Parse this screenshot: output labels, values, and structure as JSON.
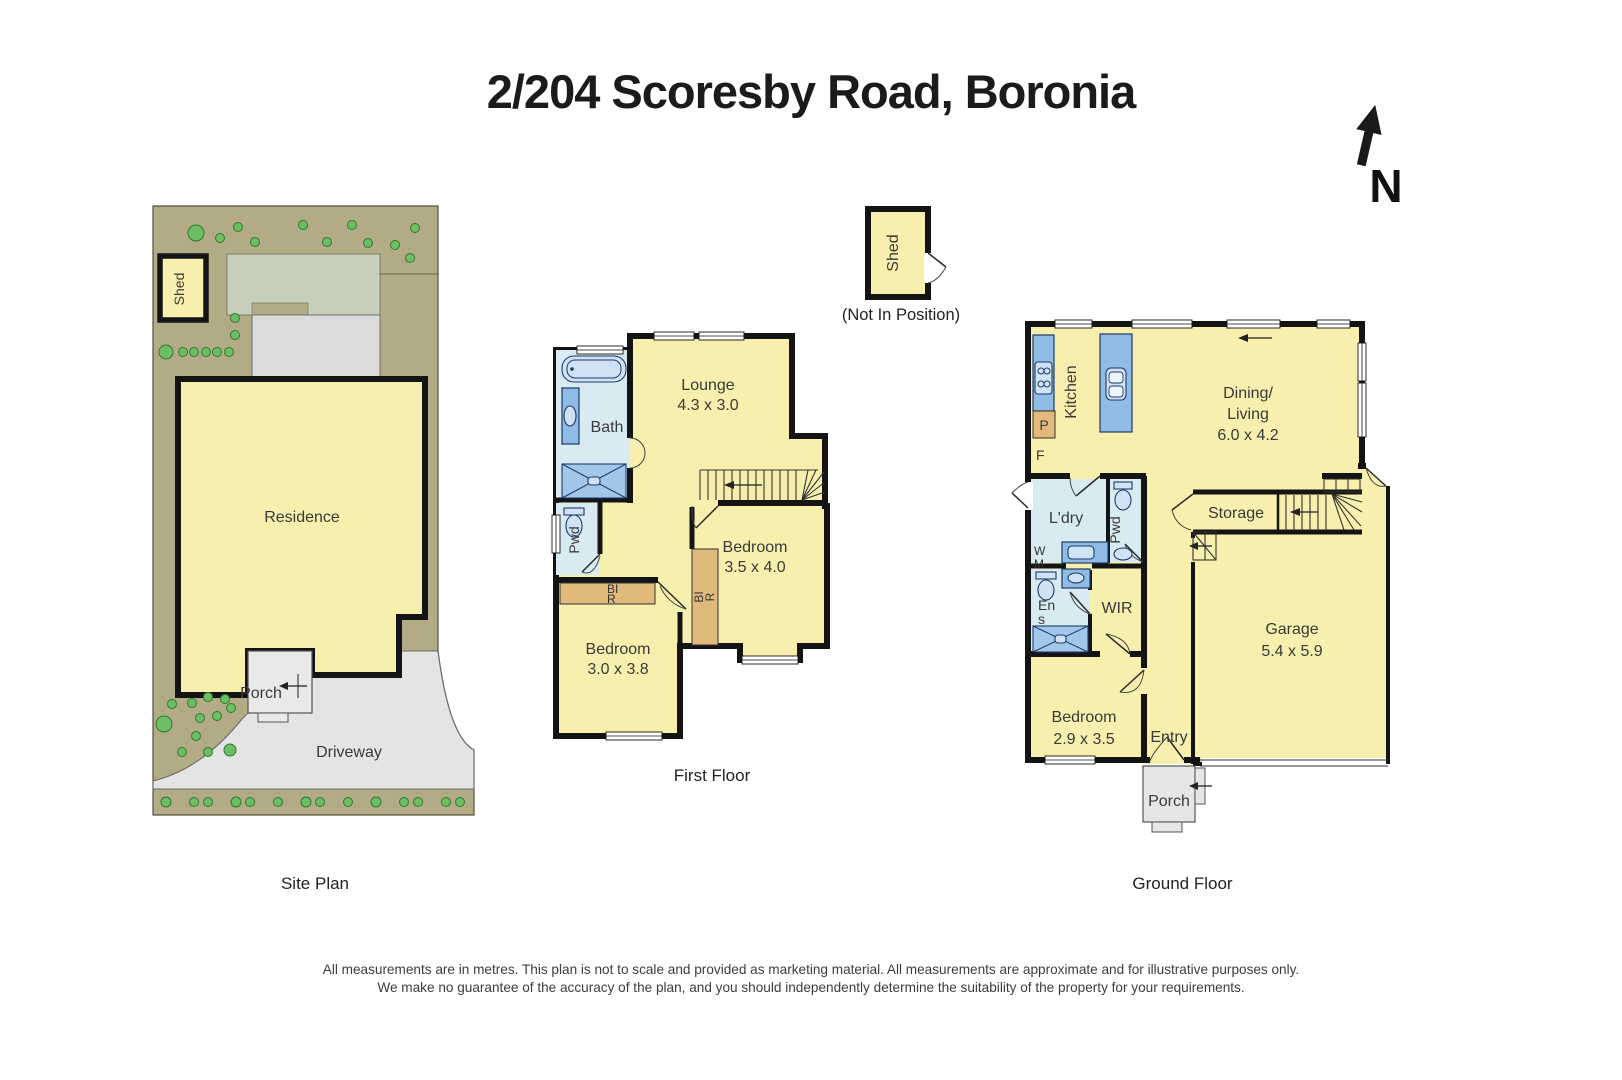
{
  "title": "2/204 Scoresby Road, Boronia",
  "compass": {
    "n": "N"
  },
  "captions": {
    "site": "Site Plan",
    "first": "First Floor",
    "ground": "Ground Floor"
  },
  "shed_out": {
    "label": "Shed",
    "note": "(Not In Position)"
  },
  "site": {
    "shed": "Shed",
    "residence": "Residence",
    "porch": "Porch",
    "driveway": "Driveway"
  },
  "first": {
    "bath": "Bath",
    "pwd": "Pwd",
    "lounge": {
      "name": "Lounge",
      "dim": "4.3 x 3.0"
    },
    "bed1": {
      "name": "Bedroom",
      "dim": "3.5 x 4.0"
    },
    "bed2": {
      "name": "Bedroom",
      "dim": "3.0 x 3.8"
    },
    "bir_h": {
      "l1": "BI",
      "l2": "R"
    },
    "bir_v": {
      "l1": "BI",
      "l2": "R"
    }
  },
  "ground": {
    "kitchen": "Kitchen",
    "pantry": "P",
    "fridge": "F",
    "dining": {
      "l1": "Dining/",
      "l2": "Living",
      "dim": "6.0 x 4.2"
    },
    "ldry": "L'dry",
    "wm": {
      "l1": "W",
      "l2": "M"
    },
    "pwd": "Pwd",
    "storage": "Storage",
    "ens": {
      "l1": "En",
      "l2": "s"
    },
    "wir": "WIR",
    "garage": {
      "name": "Garage",
      "dim": "5.4 x 5.9"
    },
    "bed": {
      "name": "Bedroom",
      "dim": "2.9 x 3.5"
    },
    "entry": "Entry",
    "porch": "Porch"
  },
  "disclaimer": {
    "line1": "All measurements are in metres. This plan is not to scale and provided as marketing material. All measurements are approximate and for illustrative purposes only.",
    "line2": "We make no guarantee of the accuracy of the plan, and you should independently determine the suitability of the property for your requirements."
  },
  "colors": {
    "room_fill": "#f7efad",
    "wall": "#141414",
    "wet_area": "#d8ebf2",
    "fixture_blue": "#8fbbe4",
    "robe_tan": "#e0ba7a",
    "site_ground": "#b3aa86",
    "lawn_green": "#c5cfb9",
    "neighbor_gray": "#dcdcdd",
    "driveway_gray": "#e4e4e4",
    "tree_green": "#6cbd63"
  }
}
